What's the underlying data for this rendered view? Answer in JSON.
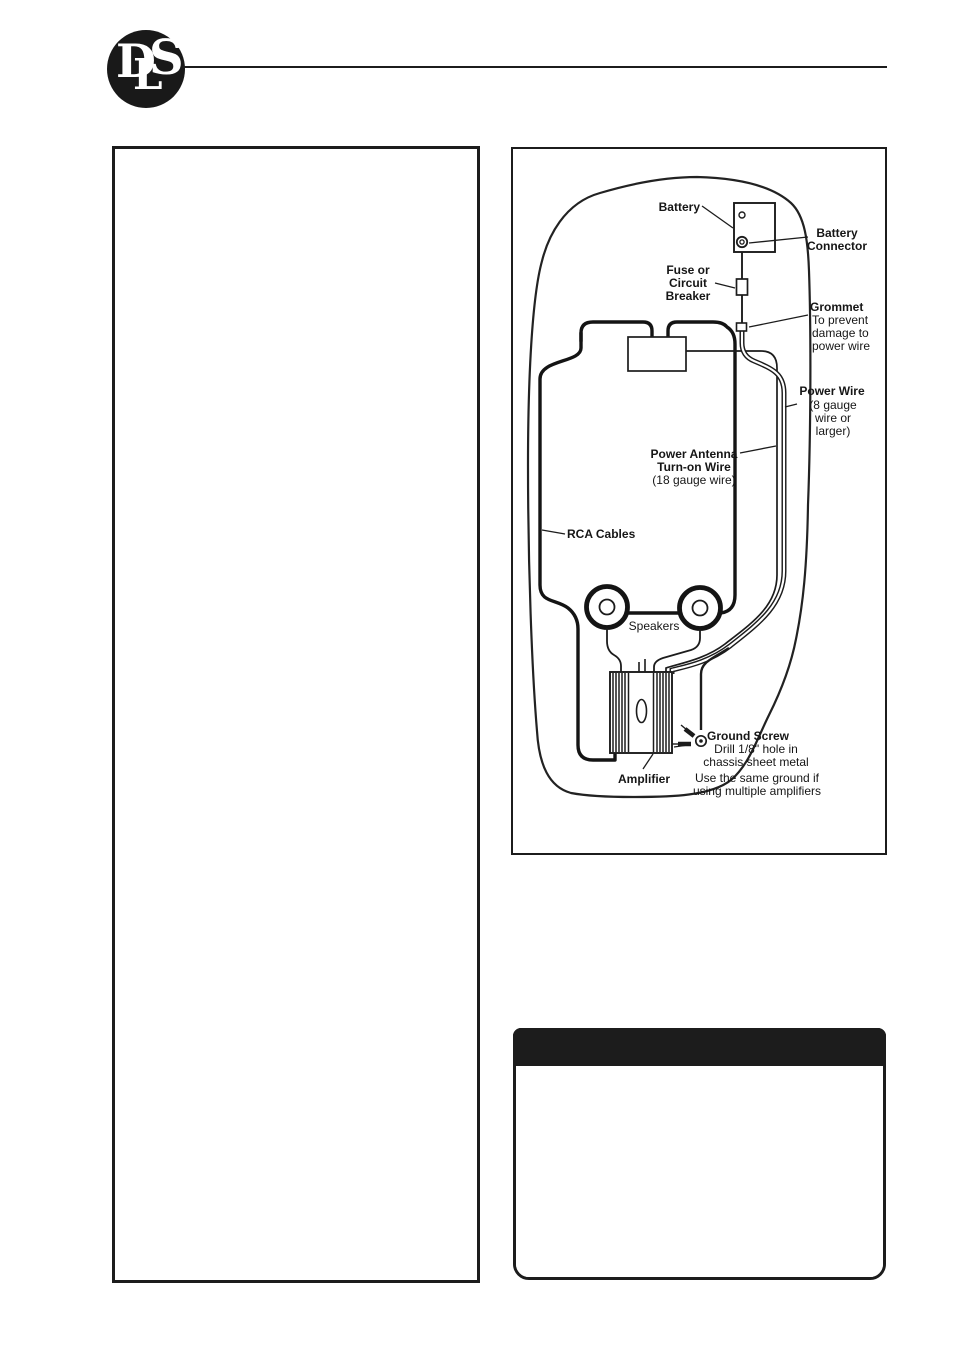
{
  "logo": {
    "text": "DLS",
    "letters": [
      "D",
      "L",
      "S"
    ]
  },
  "colors": {
    "ink": "#1c1c1c",
    "paper": "#ffffff",
    "info_header": "#1c1c1c"
  },
  "diagram": {
    "labels": {
      "battery": "Battery",
      "battery_connector": [
        "Battery",
        "Connector"
      ],
      "fuse": [
        "Fuse or",
        "Circuit",
        "Breaker"
      ],
      "grommet_title": "Grommet",
      "grommet_note": [
        "To prevent",
        "damage to",
        "power wire"
      ],
      "power_wire_title": "Power Wire",
      "power_wire_note": [
        "(8 gauge",
        "wire or",
        "larger)"
      ],
      "antenna_title": [
        "Power Antenna",
        "Turn-on Wire"
      ],
      "antenna_note": "(18 gauge wire)",
      "rca": "RCA Cables",
      "speakers": "Speakers",
      "ground_screw_title": "Ground Screw",
      "ground_screw_note": [
        "Drill 1/8\" hole in",
        "chassis sheet metal"
      ],
      "ground_screw_note2": [
        "Use the same ground if",
        "using multiple amplifiers"
      ],
      "amplifier": "Amplifier"
    }
  },
  "info_box": {
    "header_text": "",
    "body_text": ""
  },
  "left_panel": {
    "text": ""
  }
}
